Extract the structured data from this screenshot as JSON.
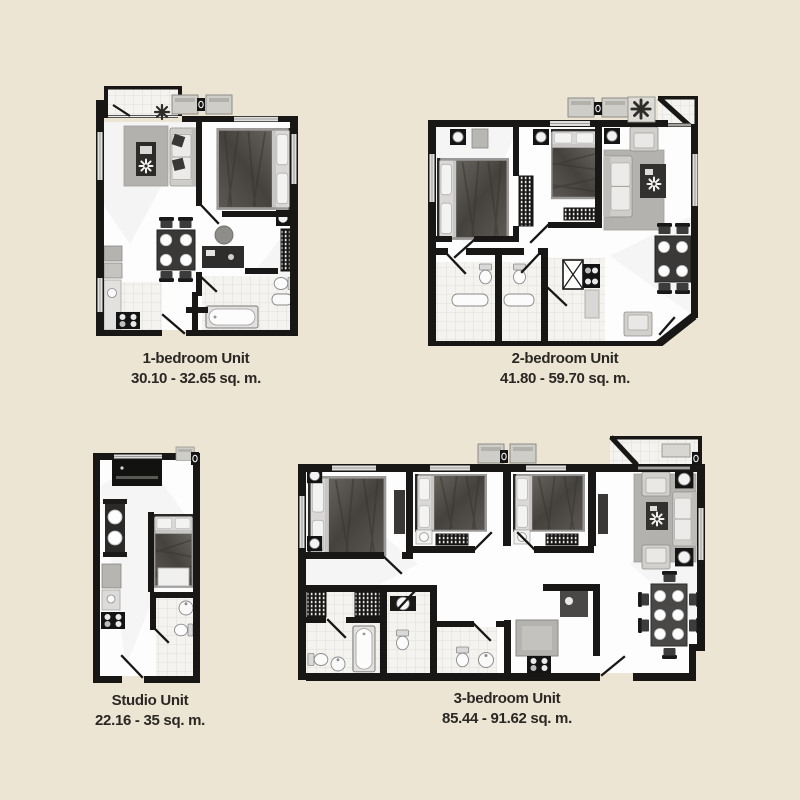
{
  "sheet": {
    "background_color": "#ece5d3",
    "wall_color": "#181715",
    "label_color": "#2a2724"
  },
  "units": [
    {
      "name": "1-bedroom Unit",
      "area_range": "30.10 - 32.65 sq. m."
    },
    {
      "name": "2-bedroom Unit",
      "area_range": "41.80 - 59.70 sq. m."
    },
    {
      "name": "Studio Unit",
      "area_range": "22.16 - 35 sq. m."
    },
    {
      "name": "3-bedroom Unit",
      "area_range": "85.44 - 91.62 sq. m."
    }
  ]
}
